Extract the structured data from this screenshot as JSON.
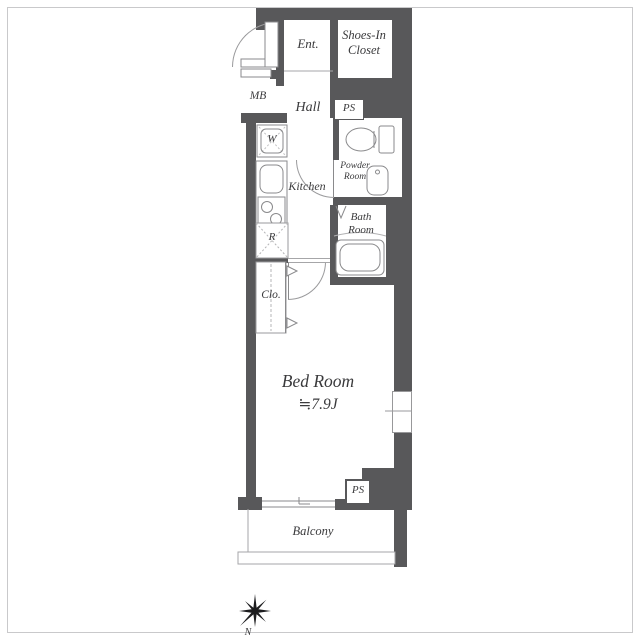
{
  "title": "Apartment floor plan 1K",
  "colors": {
    "wall": "#58585a",
    "fixture_line": "#8a8a8c",
    "thin_line": "#a6a6a8",
    "text": "#3a3a3c",
    "frame": "#c9c9cb",
    "background": "#ffffff"
  },
  "labels": {
    "ent": "Ent.",
    "shoes_closet": "Shoes-In\nCloset",
    "mb": "MB",
    "hall": "Hall",
    "ps_upper": "PS",
    "washer": "W",
    "kitchen": "Kitchen",
    "powder_room": "Powder\nRoom",
    "bath_room": "Bath\nRoom",
    "refrigerator": "R",
    "closet": "Clo.",
    "bedroom_name": "Bed Room",
    "bedroom_size": "≒7.9J",
    "ps_lower": "PS",
    "balcony": "Balcony",
    "compass_north": "N"
  }
}
